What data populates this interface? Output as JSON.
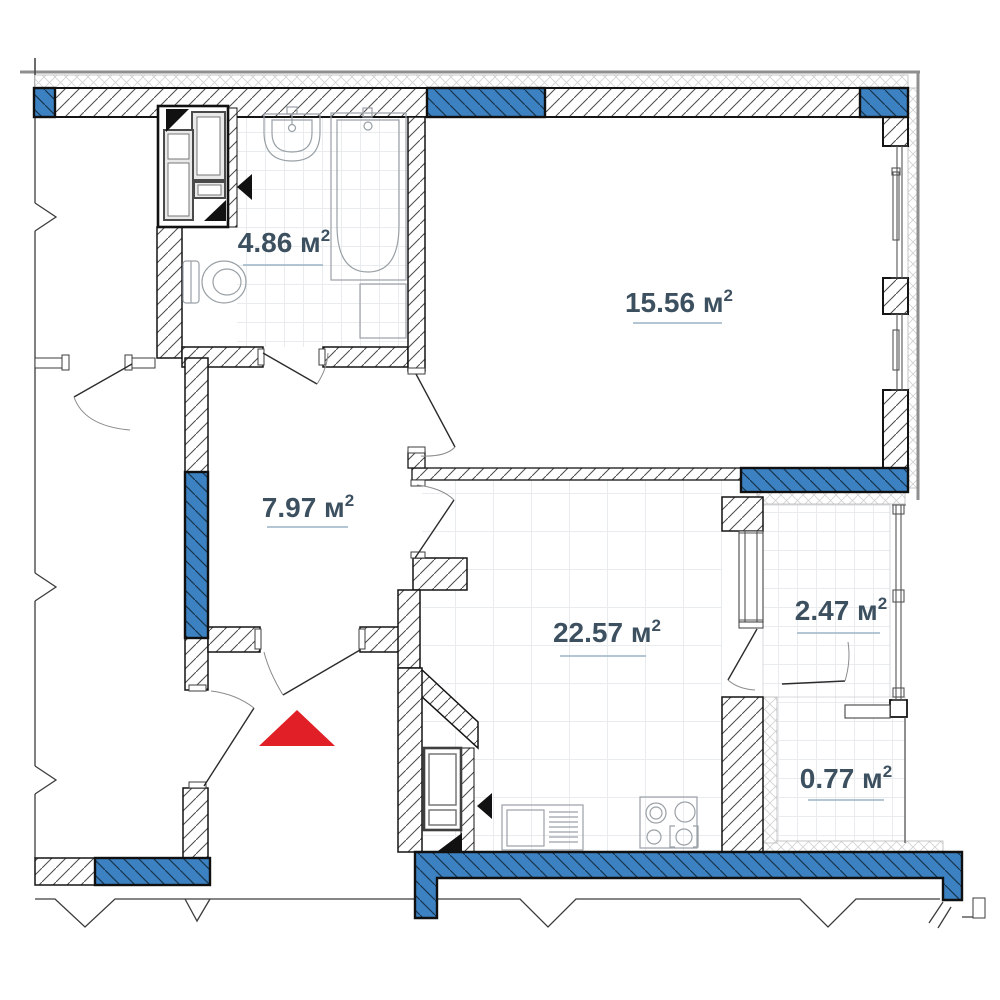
{
  "plan": {
    "kind": "apartment-floor-plan",
    "unit_system": "square-meters",
    "rooms": [
      {
        "id": "bathroom",
        "label": "4.86 м",
        "sup": "2"
      },
      {
        "id": "bedroom",
        "label": "15.56 м",
        "sup": "2"
      },
      {
        "id": "hallway",
        "label": "7.97 м",
        "sup": "2"
      },
      {
        "id": "living-kitchen",
        "label": "22.57 м",
        "sup": "2"
      },
      {
        "id": "loggia",
        "label": "2.47 м",
        "sup": "2"
      },
      {
        "id": "balcony",
        "label": "0.77 м",
        "sup": "2"
      }
    ],
    "entrance_marker": {
      "shape": "triangle",
      "color": "#e02026"
    },
    "colors": {
      "wall_blue": "#3c82c3",
      "blue_hatch": "#17344d",
      "accent_red": "#e02026",
      "label_text": "#3d5060",
      "label_underline": "#9cb4c6"
    }
  }
}
